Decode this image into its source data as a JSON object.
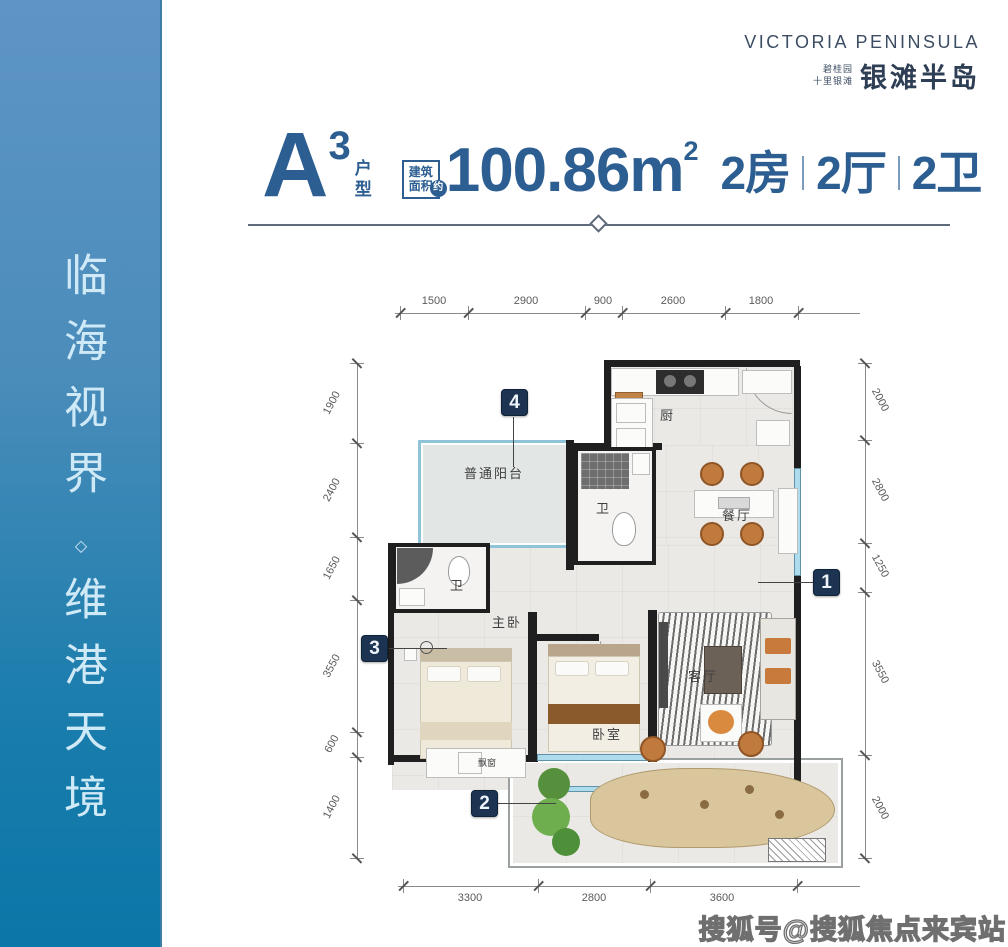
{
  "brand": {
    "name_en": "VICTORIA PENINSULA",
    "name_cn_line1": "碧桂园",
    "name_cn_line2": "十里银滩",
    "name_cn_main": "银滩半岛"
  },
  "sidebar": {
    "slogan_top": "临海视界",
    "diamond": "◇",
    "slogan_bottom": "维港天境"
  },
  "title": {
    "letter": "A",
    "sup": "3",
    "suffix_char1": "户",
    "suffix_char2": "型",
    "area_box_line1": "建筑",
    "area_box_line2": "面积",
    "area_approx": "约",
    "area_value": "100.86m",
    "area_unit_sup": "2",
    "spec_rooms": "2房",
    "spec_halls": "2厅",
    "spec_baths": "2卫"
  },
  "floorplan": {
    "dims_top": [
      "1500",
      "2900",
      "900",
      "2600",
      "1800"
    ],
    "dims_left": [
      "1900",
      "2400",
      "1650",
      "3550",
      "600",
      "1400"
    ],
    "dims_right": [
      "2000",
      "2800",
      "1250",
      "3550",
      "2000"
    ],
    "dims_bottom": [
      "3300",
      "2800",
      "3600"
    ],
    "rooms": {
      "balcony": "普通阳台",
      "kitchen": "厨",
      "bath_main": "卫",
      "dining": "餐厅",
      "master_bedroom": "主卧",
      "bath_master": "卫",
      "living": "客厅",
      "bedroom": "卧室",
      "bay_window": "飘窗"
    },
    "markers": [
      "1",
      "2",
      "3",
      "4"
    ]
  },
  "watermark": {
    "text": "搜狐号@搜狐焦点来宾站"
  },
  "colors": {
    "accent": "#2d5e92",
    "marker_bg": "#1d3352",
    "sidebar_top": "#5e95c6",
    "sidebar_bottom": "#0b76a8",
    "wall": "#1f1f1f",
    "window": "#aedcec"
  }
}
